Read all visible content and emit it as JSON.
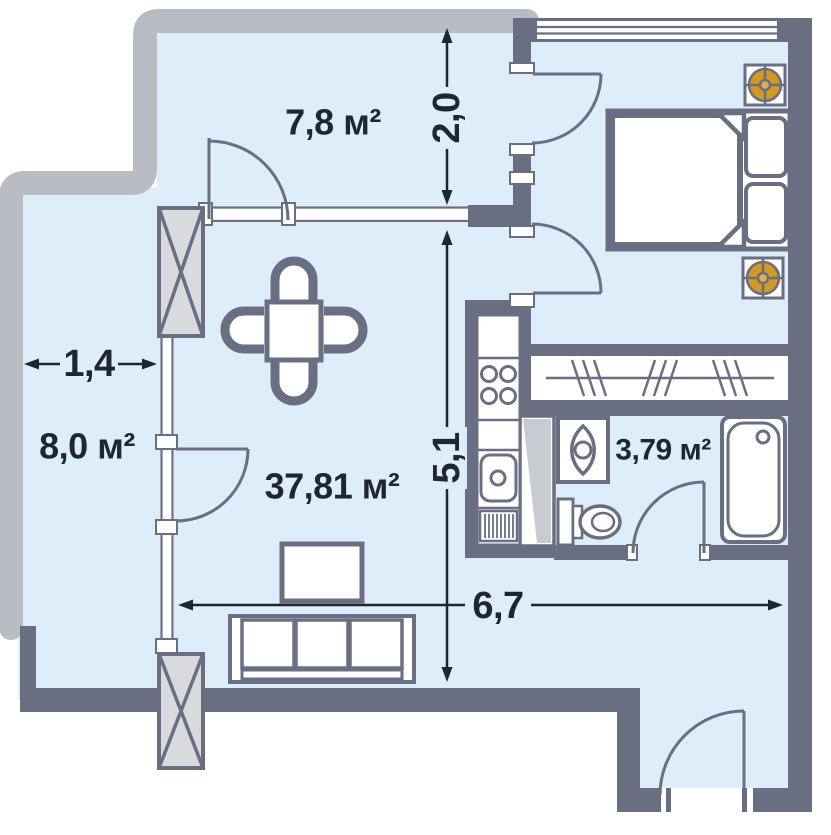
{
  "rooms": {
    "terrace": {
      "label": "7,8 м²"
    },
    "balcony": {
      "label": "8,0 м²"
    },
    "living": {
      "label": "37,81 м²"
    },
    "bathroom": {
      "label": "3,79 м²"
    }
  },
  "dimensions": {
    "terrace_depth": {
      "label": "2,0"
    },
    "balcony_width": {
      "label": "1,4"
    },
    "living_length": {
      "label": "5,1"
    },
    "living_width": {
      "label": "6,7"
    }
  },
  "colors": {
    "floor": "#ddedfa",
    "wall": "#6a6e83",
    "outline": "#b9bcc2",
    "vent-orange": "#d29a1e",
    "vent-center": "#dcb14d",
    "label-text": "#1f2633",
    "column-fill": "#d9dade",
    "shaft-fill": "#c9cbd2"
  }
}
